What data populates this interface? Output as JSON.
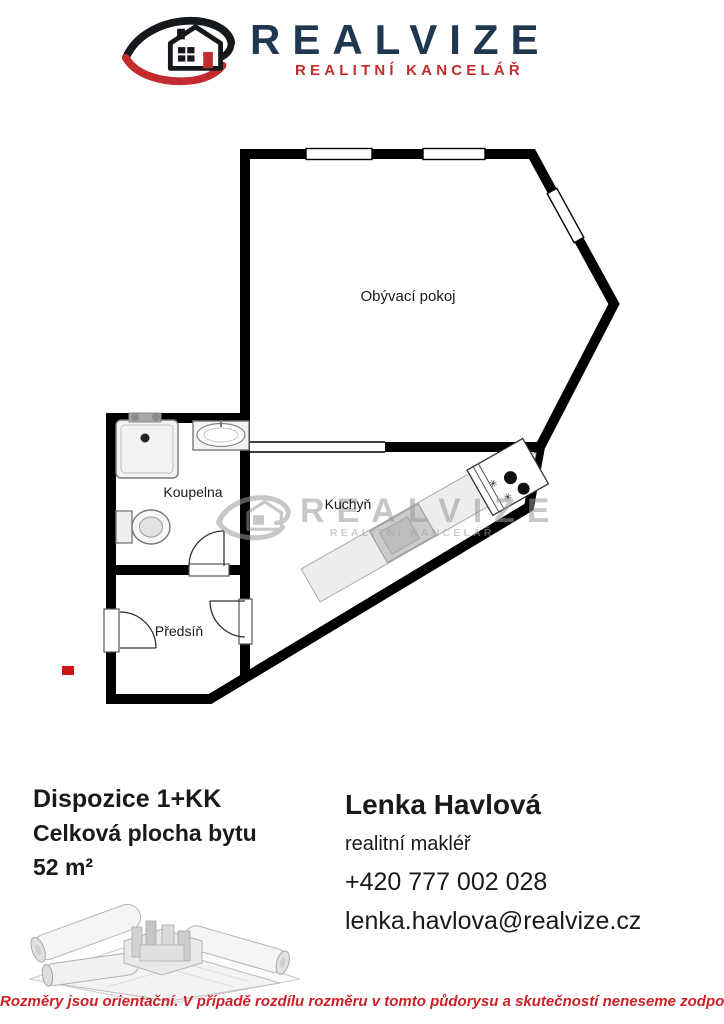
{
  "header": {
    "brand": "REALVIZE",
    "tagline": "REALITNÍ KANCELÁŘ"
  },
  "colors": {
    "brand_navy": "#1f3850",
    "brand_red": "#c22c2e",
    "disclaimer_red": "#cc2128",
    "wall_black": "#000000",
    "counter_gray": "#ededed",
    "watermark_gray": "#9a9a9a",
    "red_mark": "#cc1719"
  },
  "floorplan": {
    "rooms": [
      {
        "label": "Obývací pokoj"
      },
      {
        "label": "Koupelna"
      },
      {
        "label": "Kuchyň"
      },
      {
        "label": "Předsíň"
      }
    ],
    "watermark": {
      "brand": "REALVIZE",
      "tagline": "REALITNÍ KANCELÁŘ"
    }
  },
  "details": {
    "disposition": "Dispozice 1+KK",
    "area_label": "Celková plocha bytu",
    "area_value": "52 m²"
  },
  "agent": {
    "name": "Lenka Havlová",
    "role": "realitní makléř",
    "phone": "+420 777 002 028",
    "email": "lenka.havlova@realvize.cz"
  },
  "footer": {
    "disclaimer": "Rozměry jsou orientační. V případě rozdílu rozměru v tomto půdorysu a skutečností neneseme zodpovědnost"
  }
}
